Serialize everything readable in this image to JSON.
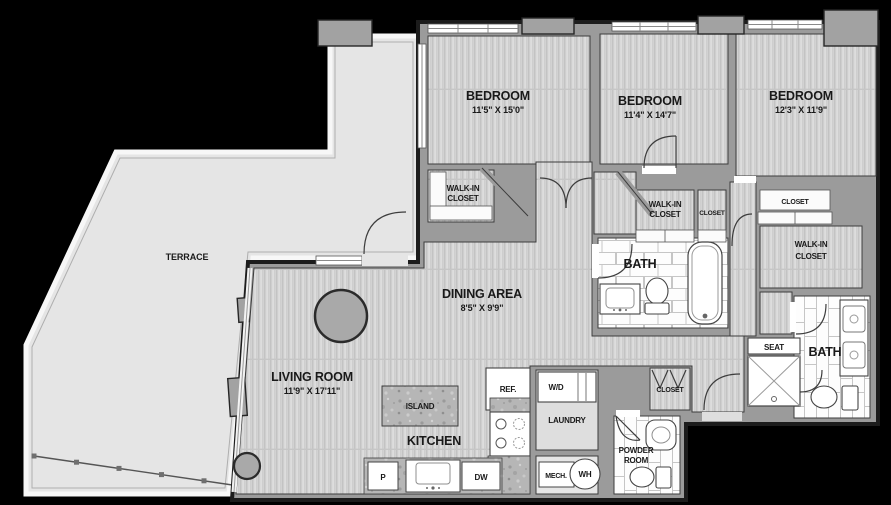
{
  "plan": {
    "type": "residential-floor-plan",
    "colors": {
      "background": "#000000",
      "terrace_floor": "#e5e5e5",
      "wall_gray": "#9b9b9b",
      "wood_floor": "#d4d4d4",
      "tile_white": "#fdfdfd",
      "granite": "#b6b6b6",
      "outline_dark": "#1c1c1c",
      "label_text": "#191919"
    },
    "rooms": {
      "bed1": {
        "name": "BEDROOM",
        "dims": "11'5\" X 15'0\""
      },
      "bed2": {
        "name": "BEDROOM",
        "dims": "11'4\" X 14'7\""
      },
      "bed3": {
        "name": "BEDROOM",
        "dims": "12'3\" X 11'9\""
      },
      "living": {
        "name": "LIVING ROOM",
        "dims": "11'9\" X 17'11\""
      },
      "dining": {
        "name": "DINING AREA",
        "dims": "8'5\" X 9'9\""
      },
      "kitchen": {
        "name": "KITCHEN"
      },
      "terrace": {
        "name": "TERRACE"
      },
      "island": {
        "name": "ISLAND"
      },
      "bath": {
        "name": "BATH"
      },
      "powder": {
        "name1": "POWDER",
        "name2": "ROOM"
      },
      "laundry": {
        "name": "LAUNDRY"
      },
      "walkin": {
        "name1": "WALK-IN",
        "name2": "CLOSET"
      },
      "closet": {
        "name": "CLOSET"
      },
      "seat": {
        "name": "SEAT"
      }
    },
    "fixtures": {
      "ref": "REF.",
      "washer_dryer": "W/D",
      "water_heater": "WH",
      "mechanical": "MECH.",
      "pantry": "P",
      "dishwasher": "DW"
    }
  }
}
